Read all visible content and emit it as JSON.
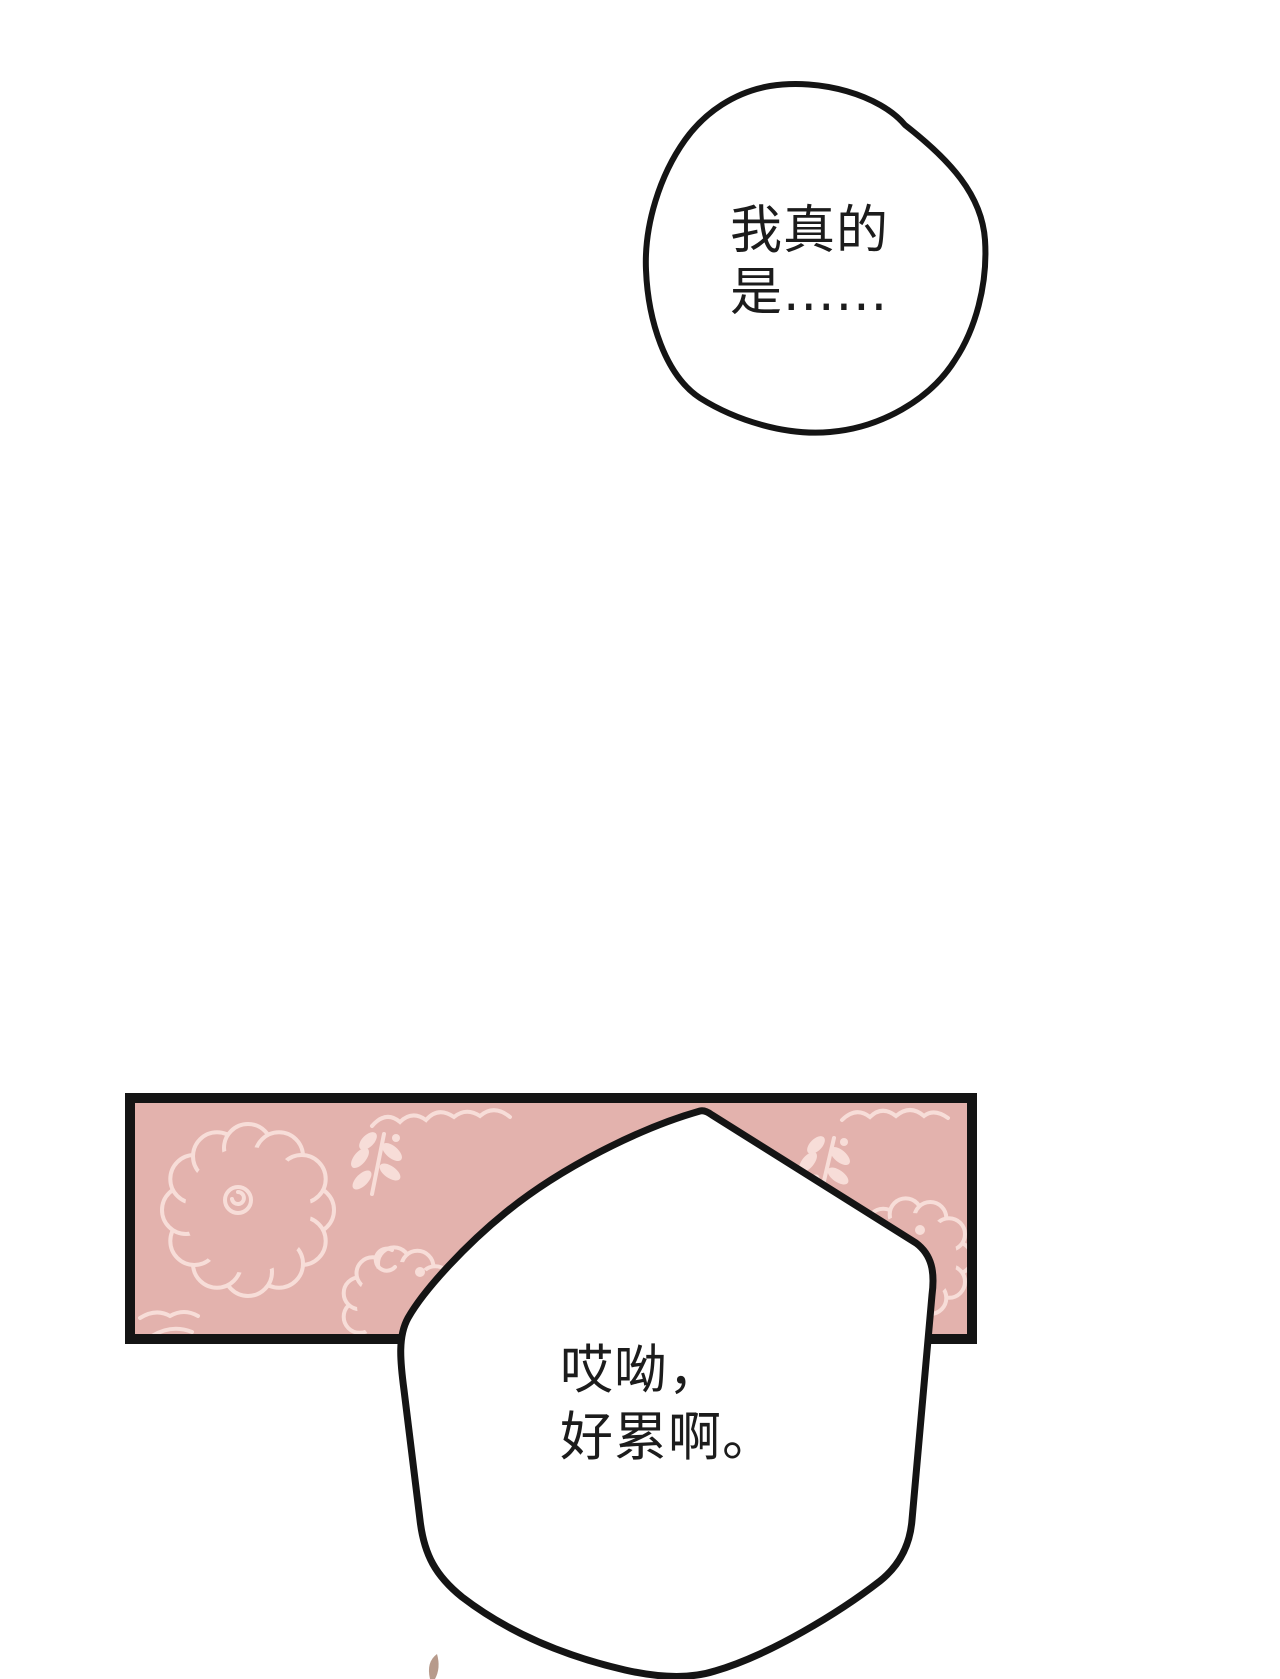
{
  "page": {
    "kind": "comic-panel",
    "background": "#ffffff"
  },
  "colors": {
    "background": "#ffffff",
    "panel_fill": "#e3b2ad",
    "panel_border": "#141414",
    "doodle": "#f7ddd8",
    "ink": "#141414",
    "text": "#1c1c1c",
    "strand": "#b79a8b"
  },
  "bubbles": {
    "top": {
      "line1": "我真的",
      "line2": "是......"
    },
    "bottom": {
      "line1": "哎呦，",
      "line2": "好累啊。"
    }
  },
  "panel": {
    "pattern_motifs": [
      "sheep-doodle",
      "leaf-sprig",
      "scallop-wave"
    ]
  }
}
